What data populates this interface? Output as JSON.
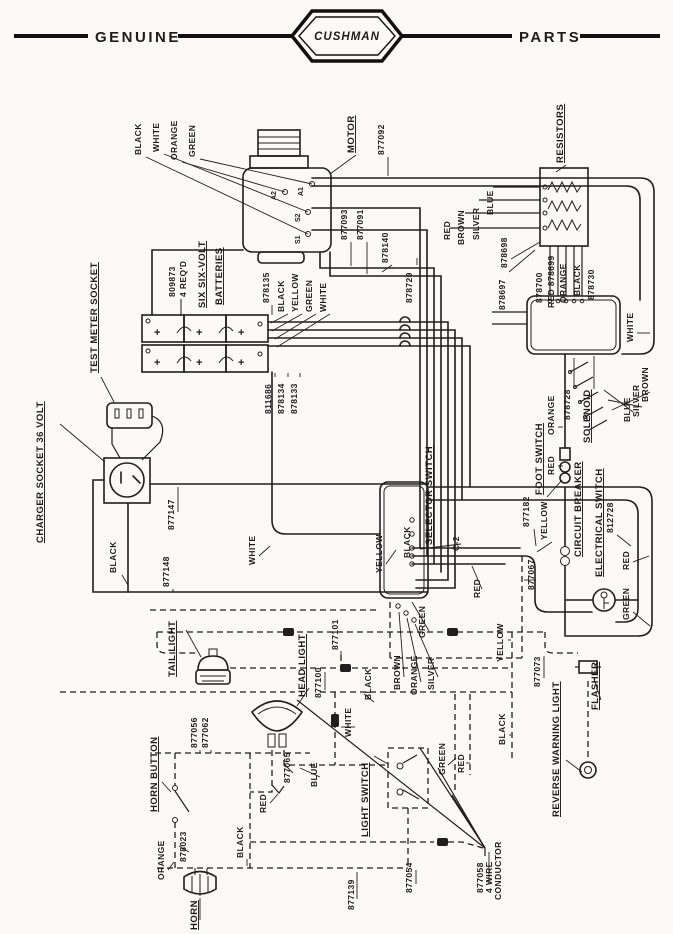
{
  "header": {
    "left_label": "GENUINE",
    "brand": "CUSHMAN",
    "right_label": "PARTS"
  },
  "motor": {
    "title": "MOTOR",
    "part_877092": "877092",
    "part_877093": "877093",
    "part_877091": "877091",
    "part_878140": "878140",
    "wire_black": "BLACK",
    "wire_white": "WHITE",
    "wire_orange": "ORANGE",
    "wire_green": "GREEN",
    "term_a2": "A2",
    "term_a1": "A1",
    "term_s2": "S2",
    "term_s1": "S1"
  },
  "resistors": {
    "title": "RESISTORS",
    "wire_red": "RED",
    "wire_brown": "BROWN",
    "wire_silver": "SILVER",
    "wire_blue": "BLUE",
    "part_878698": "878698",
    "part_878697": "878697",
    "part_878700": "878700",
    "red_878699": "RED 878699",
    "wire_orange": "ORANGE",
    "wire_black": "BLACK",
    "part_878730": "878730",
    "part_878729": "878729"
  },
  "batteries": {
    "title_line1": "SIX SIX-VOLT",
    "title_line2": "BATTERIES",
    "part": "809873",
    "qty": "4 REQ'D",
    "plus": "+",
    "part_878135": "878135",
    "wire_black": "BLACK",
    "wire_yellow": "YELLOW",
    "wire_green": "GREEN",
    "wire_white": "WHITE",
    "part_811686": "811686",
    "part_878134": "878134",
    "part_878133": "878133"
  },
  "test_meter_socket": {
    "title": "TEST METER SOCKET"
  },
  "charger_socket": {
    "title": "CHARGER SOCKET 36 VOLT",
    "part_877147": "877147",
    "part_877148": "877148",
    "wire_black": "BLACK"
  },
  "selector_switch": {
    "title": "SELECTOR SWITCH",
    "terminal_c2": "C-2",
    "wire_yellow": "YELLOW",
    "wire_black": "BLACK",
    "wire_red": "RED",
    "wire_green": "GREEN",
    "wire_brown": "BROWN",
    "wire_orange": "ORANGE",
    "wire_silver": "SILVER"
  },
  "harness": {
    "wire_white": "WHITE",
    "part_877067": "877067",
    "part_877073": "877073",
    "wire_yellow": "YELLOW",
    "wire_black": "BLACK"
  },
  "foot_switch": {
    "title": "FOOT SWITCH",
    "part": "877182",
    "wire_yellow": "YELLOW",
    "wire_orange": "ORANGE",
    "wire_red": "RED"
  },
  "solenoid": {
    "title": "SOLENOID",
    "part": "878728",
    "wire_blue": "BLUE",
    "wire_silver": "SILVER",
    "wire_brown": "BROWN",
    "wire_white": "WHITE"
  },
  "circuit_breaker": {
    "title": "CIRCUIT BREAKER"
  },
  "electrical_switch": {
    "title": "ELECTRICAL SWITCH",
    "part": "812728",
    "wire_red": "RED",
    "wire_green": "GREEN"
  },
  "tail_light": {
    "title": "TAIL LIGHT",
    "part_877101": "877101"
  },
  "head_light": {
    "title": "HEAD LIGHT",
    "part_877100": "877100",
    "wire_white": "WHITE",
    "wire_black": "BLACK",
    "wire_blue": "BLUE",
    "part_877056": "877056",
    "part_877062": "877062",
    "part_877065": "877065"
  },
  "light_switch": {
    "title": "LIGHT SWITCH",
    "wire_green": "GREEN",
    "wire_red": "RED",
    "part_877139": "877139",
    "part_877054": "877054",
    "part_877058": "877058",
    "conductor_line1": "4 WIRE",
    "conductor_line2": "CONDUCTOR"
  },
  "horn": {
    "title": "HORN",
    "button_title": "HORN BUTTON",
    "wire_orange": "ORANGE",
    "part_878023": "878023",
    "wire_black": "BLACK",
    "wire_red": "RED"
  },
  "flasher": {
    "title": "FLASHER"
  },
  "reverse_warning_light": {
    "title": "REVERSE WARNING LIGHT"
  }
}
